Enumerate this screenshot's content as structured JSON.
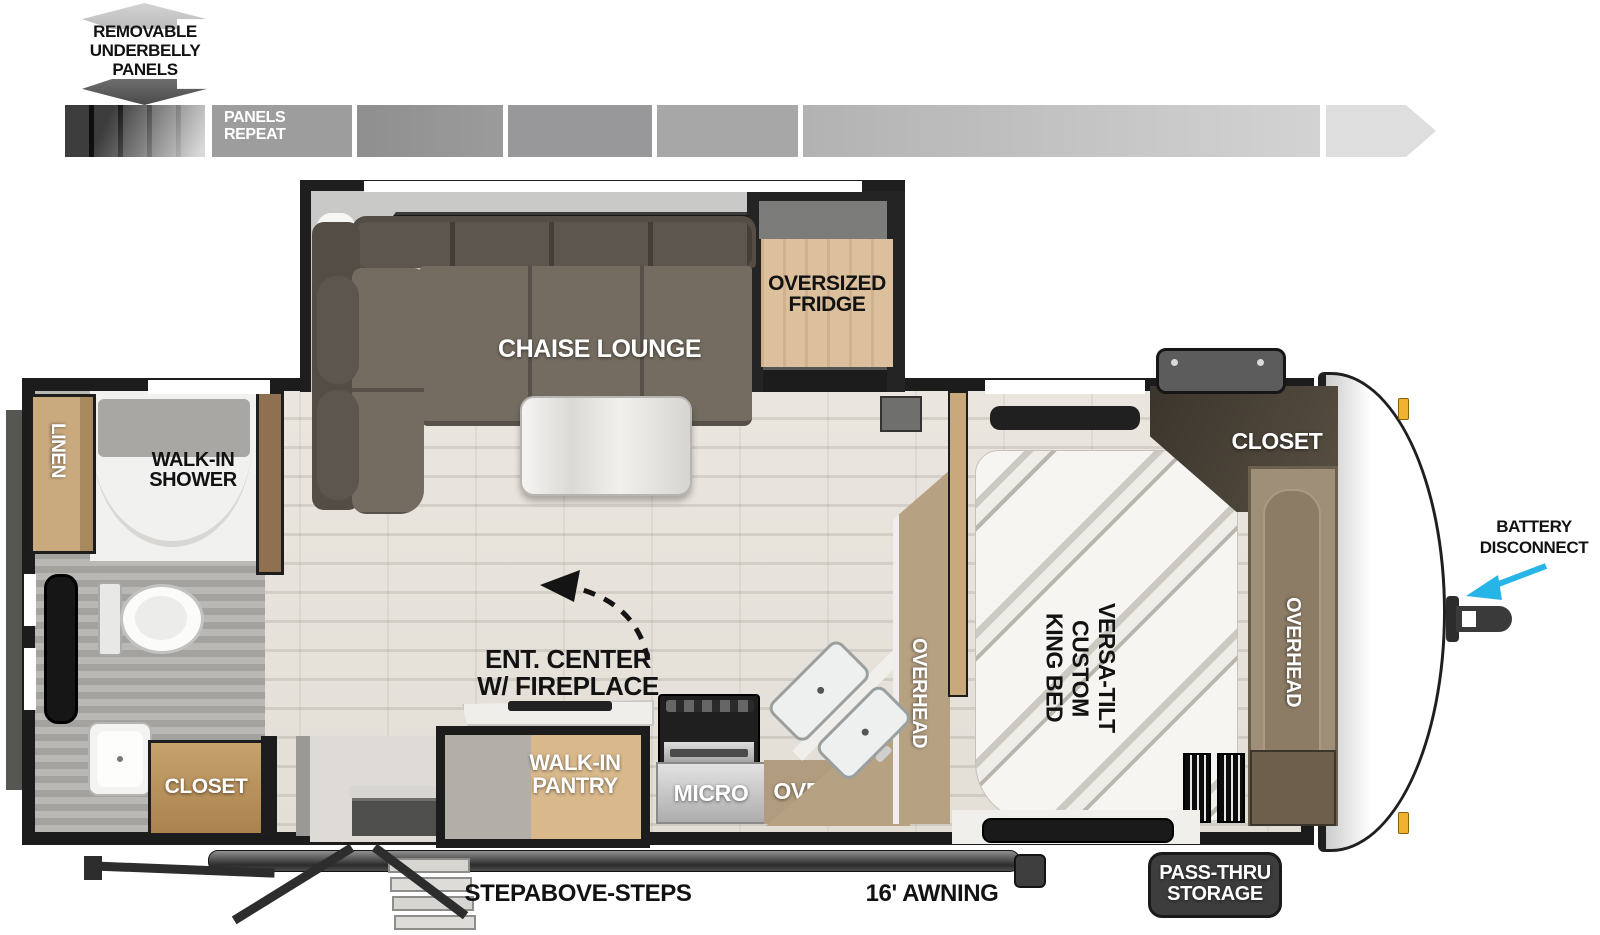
{
  "labels": {
    "underbelly_line1": "REMOVABLE",
    "underbelly_line2": "UNDERBELLY",
    "underbelly_line3": "PANELS",
    "panels_repeat_line1": "PANELS",
    "panels_repeat_line2": "REPEAT",
    "chaise_lounge": "CHAISE LOUNGE",
    "fridge_line1": "OVERSIZED",
    "fridge_line2": "FRIDGE",
    "shower_line1": "WALK-IN",
    "shower_line2": "SHOWER",
    "linen": "LINEN",
    "bath_closet": "CLOSET",
    "ent_center_line1": "ENT. CENTER",
    "ent_center_line2": "W/ FIREPLACE",
    "pantry_line1": "WALK-IN",
    "pantry_line2": "PANTRY",
    "micro": "MICRO",
    "kitchen_overhead": "OVERHEAD",
    "kitchen_overhead_vertical": "OVERHEAD",
    "bed_line1": "VERSA-TILT",
    "bed_line2": "CUSTOM",
    "bed_line3": "KING BED",
    "bedroom_closet": "CLOSET",
    "front_overhead": "OVERHEAD",
    "battery_line1": "BATTERY",
    "battery_line2": "DISCONNECT",
    "passthru_line1": "PASS-THRU",
    "passthru_line2": "STORAGE",
    "stepabove": "STEPABOVE-STEPS",
    "awning": "16' AWNING"
  },
  "colors": {
    "wall": "#1c1c1c",
    "floor": "#e9e5de",
    "battery_arrow": "#27b5e8",
    "marker_light": "#f0b232",
    "wood_cabinet": "#c9a87c",
    "dark_closet": "#463f34",
    "sofa_cushion": "#746c60",
    "fridge_wood": "#dcc09e"
  }
}
